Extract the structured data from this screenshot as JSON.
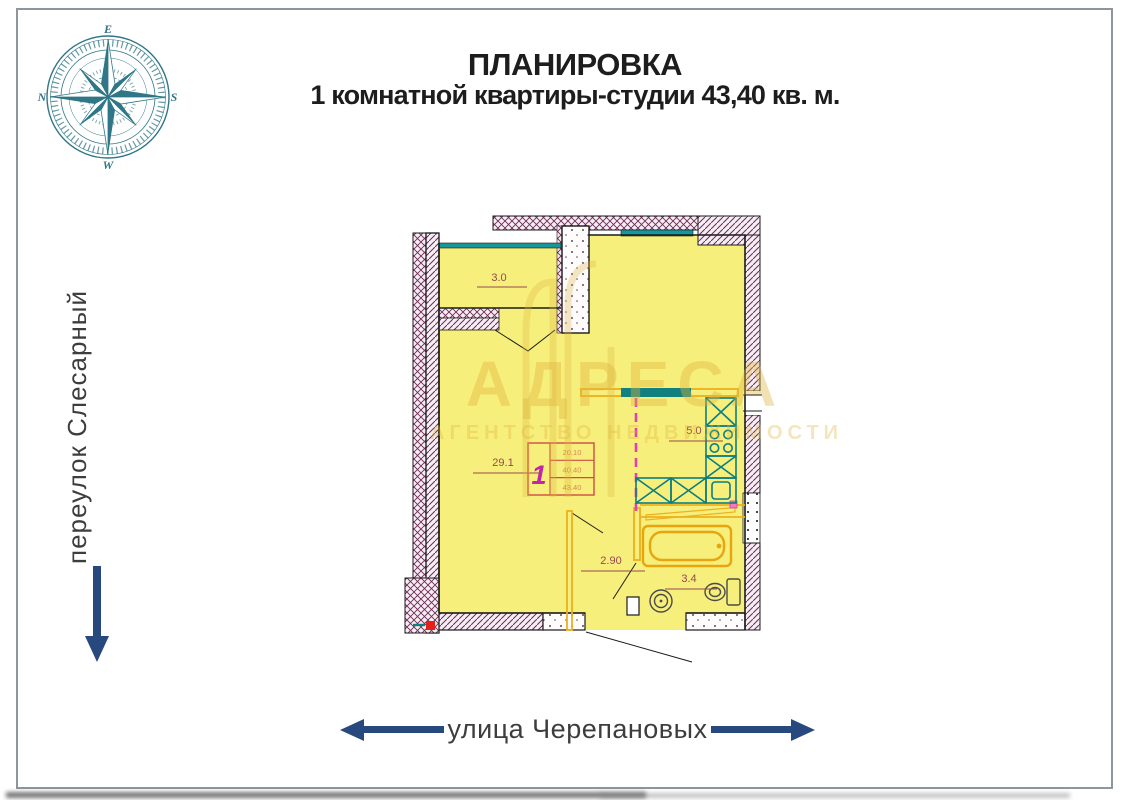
{
  "title": {
    "line1": "ПЛАНИРОВКА",
    "line2": "1 комнатной квартиры-студии 43,40 кв. м."
  },
  "compass": {
    "top": "E",
    "right": "S",
    "bottom": "W",
    "left": "N"
  },
  "streets": {
    "left_vertical": "переулок Слесарный",
    "bottom": "улица Черепановых"
  },
  "watermark": {
    "brand": "АДРЕСА",
    "subtitle": "АГЕНТСТВО НЕДВИЖИМОСТИ"
  },
  "floorplan": {
    "total_area_sqm": "43,40",
    "rooms": [
      {
        "area": "3.0"
      },
      {
        "area": "29.1"
      },
      {
        "area": "5.0"
      },
      {
        "area": "2.90"
      },
      {
        "area": "3.4"
      }
    ],
    "stamp": {
      "flat_number": "1",
      "living_area": "20.10",
      "area_no_balcony": "40.40",
      "total_area": "43.40"
    }
  },
  "colors": {
    "arrow_blue": "#27497e",
    "compass_teal": "#19687a",
    "room_yellow": "#f7ef7b",
    "wall_maroon": "#6d2a52",
    "window_teal": "#16989a",
    "fixture_teal": "#0c7d80",
    "partition_orange": "#edb01e",
    "divider_magenta": "#e23fb4",
    "label_red": "#96484e"
  }
}
